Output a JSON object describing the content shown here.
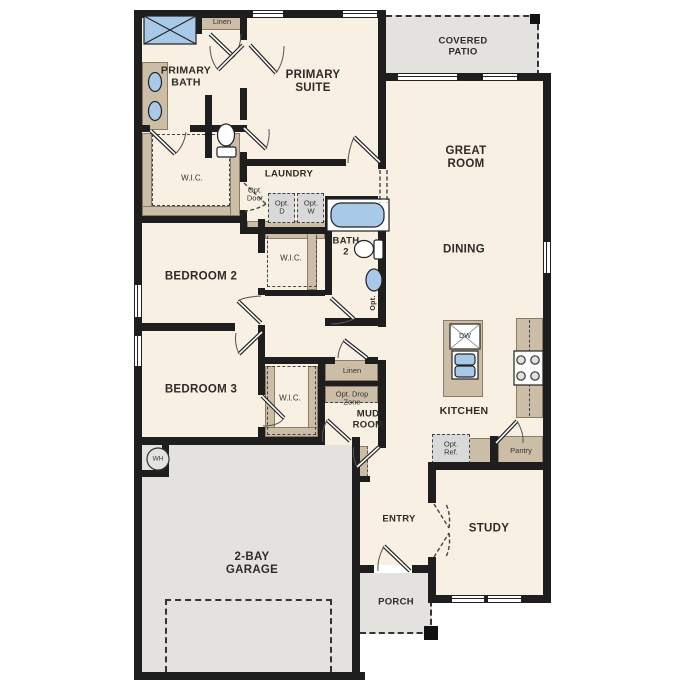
{
  "colors": {
    "wall": "#1e1e1e",
    "floor": "#f8f0e2",
    "outdoor": "#e3e2df",
    "cabinet": "#ccbda6",
    "fixture": "#a9c9e9",
    "text": "#2e2b28"
  },
  "labels": {
    "linen_top": "Linen",
    "primary_bath": "PRIMARY\nBATH",
    "primary_suite": "PRIMARY\nSUITE",
    "covered_patio": "COVERED\nPATIO",
    "great_room": "GREAT\nROOM",
    "wic_primary": "W.I.C.",
    "laundry": "LAUNDRY",
    "opt_door": "Opt.\nDoor",
    "opt_d": "Opt.\nD",
    "opt_w": "Opt.\nW",
    "bath_2": "BATH\n2",
    "dining": "DINING",
    "bedroom_2": "BEDROOM 2",
    "wic_bedroom_2": "W.I.C.",
    "opt_vanity": "Opt.",
    "bedroom_3": "BEDROOM 3",
    "wic_bedroom_3": "W.I.C.",
    "linen_hall": "Linen",
    "opt_drop_zone": "Opt. Drop\nZone",
    "mud_room": "MUD\nROOM",
    "kitchen": "KITCHEN",
    "dishwasher": "DW",
    "opt_ref": "Opt.\nRef.",
    "pantry": "Pantry",
    "water_heater": "WH",
    "entry": "ENTRY",
    "study": "STUDY",
    "garage": "2-BAY\nGARAGE",
    "porch": "PORCH"
  }
}
